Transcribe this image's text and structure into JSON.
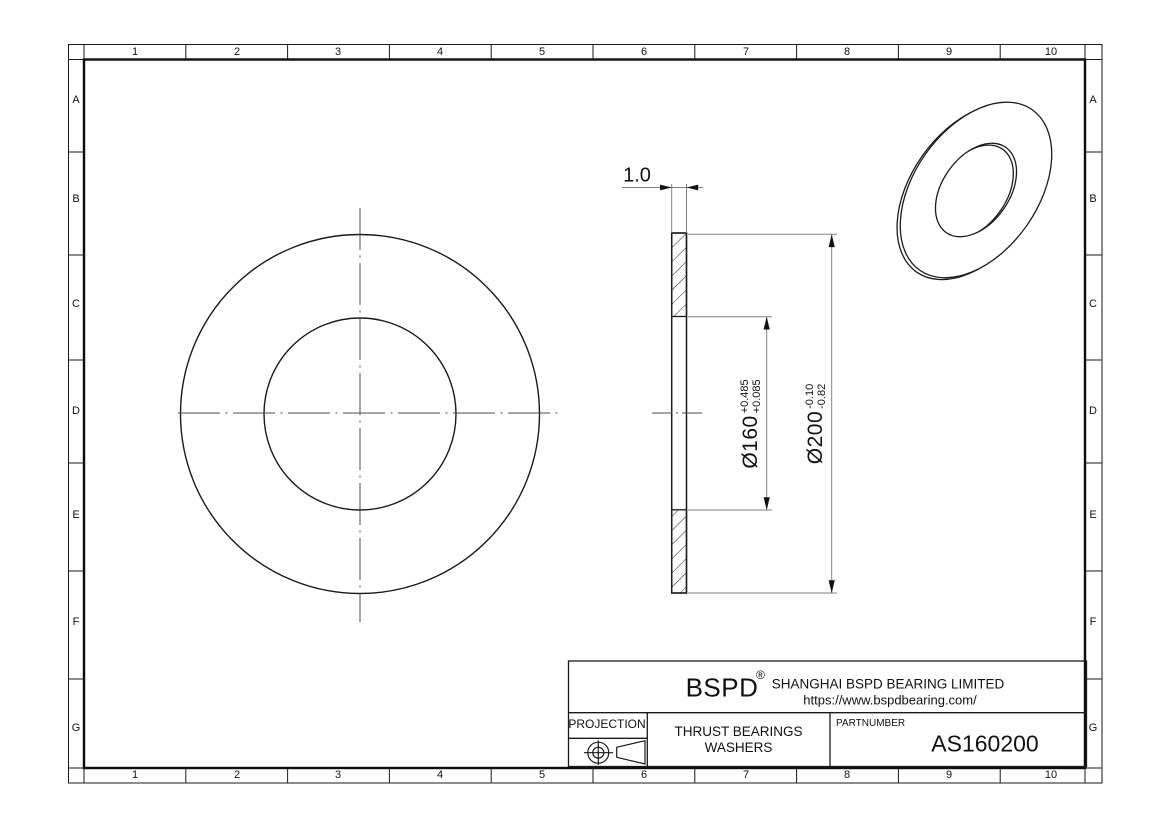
{
  "sheet": {
    "grid": {
      "columns": [
        "1",
        "2",
        "3",
        "4",
        "5",
        "6",
        "7",
        "8",
        "9",
        "10"
      ],
      "rows": [
        "A",
        "B",
        "C",
        "D",
        "E",
        "F",
        "G"
      ]
    },
    "dimensions": {
      "thickness": "1.0",
      "bore_diameter": "Ø160",
      "bore_tol_upper": "+0.485",
      "bore_tol_lower": "+0.085",
      "outer_diameter": "Ø200",
      "outer_tol_upper": "-0.10",
      "outer_tol_lower": "-0.82"
    },
    "title_block": {
      "logo": "BSPD",
      "registered_mark": "®",
      "company": "SHANGHAI BSPD BEARING LIMITED",
      "website": "https://www.bspdbearing.com/",
      "projection_label": "PROJECTION",
      "product_line1": "THRUST BEARINGS",
      "product_line2": "WASHERS",
      "partnumber_label": "PARTNUMBER",
      "partnumber_value": "AS160200"
    },
    "colors": {
      "outline": "#1a1a1a",
      "dim_line": "#808080",
      "center_line": "#4d4d4d",
      "background": "#ffffff"
    }
  }
}
